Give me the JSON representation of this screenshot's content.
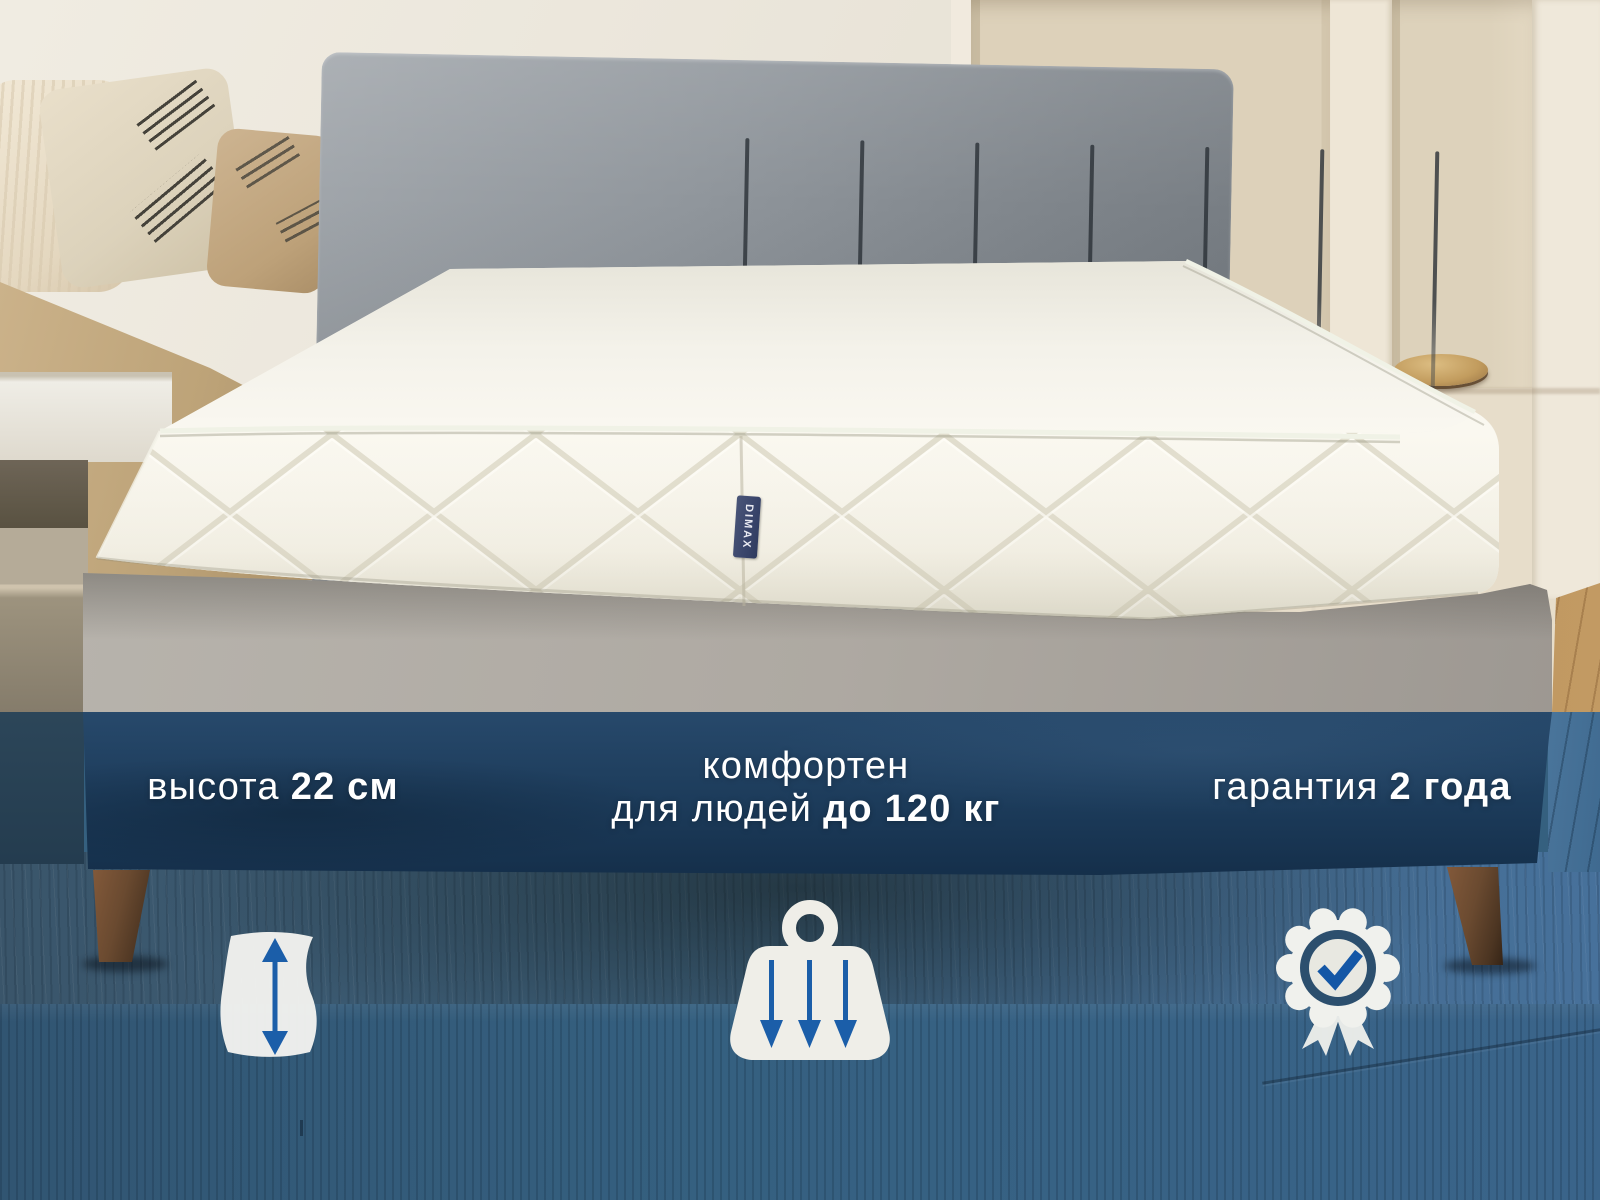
{
  "product_photo": {
    "brand_tag": "DIMAX",
    "features": {
      "height": {
        "label": "высота",
        "value": "22 см"
      },
      "weight": {
        "line1": "комфортен",
        "line2_label": "для людей",
        "line2_value": "до 120 кг"
      },
      "warranty": {
        "label": "гарантия",
        "value": "2 года"
      }
    },
    "icons": {
      "height": "mattress-height-arrow-icon",
      "weight": "weight-load-arrows-icon",
      "warranty": "award-badge-check-icon"
    },
    "colors": {
      "overlay_navy": "#1d3a56",
      "accent_blue": "#1b5ea9",
      "text": "#ffffff"
    }
  }
}
